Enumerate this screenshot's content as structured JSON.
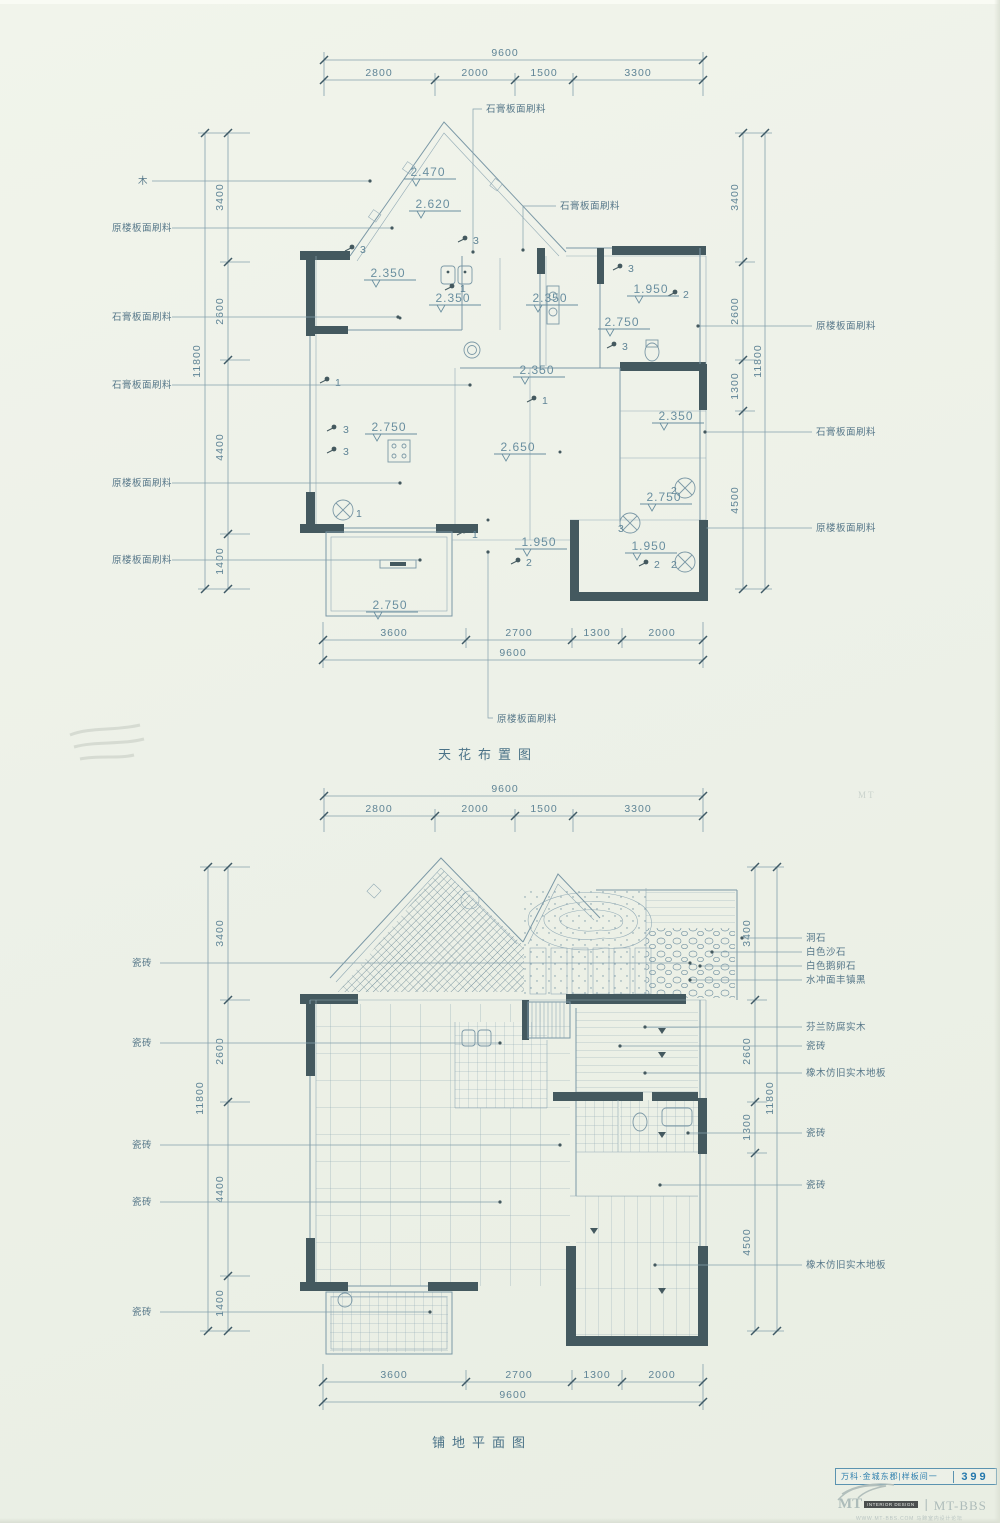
{
  "colors": {
    "paper": "#edf1e8",
    "line": "#7b98a6",
    "dark": "#44595f",
    "text": "#5f8496",
    "blue": "#2e7fae",
    "watermark": "#aebcba"
  },
  "top_plan": {
    "title": "天花布置图",
    "dims": {
      "top_total": "9600",
      "top_segments": [
        "2800",
        "2000",
        "1500",
        "3300"
      ],
      "bottom_total": "9600",
      "bottom_segments": [
        "3600",
        "2700",
        "1300",
        "2000"
      ],
      "left_total": "11800",
      "left_segments": [
        "3400",
        "2600",
        "4400",
        "1400"
      ],
      "right_total": "11800",
      "right_segments": [
        "3400",
        "2600",
        "1300",
        "4500"
      ]
    },
    "labels_left": [
      "木",
      "原楼板面刷料",
      "石膏板面刷料",
      "石膏板面刷料",
      "原楼板面刷料",
      "原楼板面刷料"
    ],
    "labels_right": [
      "原楼板面刷料",
      "石膏板面刷料",
      "原楼板面刷料"
    ],
    "labels_top": [
      "石膏板面刷料",
      "石膏板面刷料"
    ],
    "label_bottom": "原楼板面刷料",
    "levels": [
      "2.470",
      "2.620",
      "2.350",
      "2.350",
      "2.350",
      "1.950",
      "2.750",
      "2.350",
      "2.350",
      "2.750",
      "2.650",
      "2.750",
      "1.950",
      "1.950",
      "2.750"
    ],
    "fixture_tags": [
      "3",
      "3",
      "1",
      "3",
      "3",
      "1",
      "1",
      "1",
      "3",
      "2",
      "3",
      "2",
      "2",
      "1",
      "3",
      "2",
      "2"
    ]
  },
  "bottom_plan": {
    "title": "铺地平面图",
    "dims": {
      "top_total": "9600",
      "top_segments": [
        "2800",
        "2000",
        "1500",
        "3300"
      ],
      "bottom_total": "9600",
      "bottom_segments": [
        "3600",
        "2700",
        "1300",
        "2000"
      ],
      "left_total": "11800",
      "left_segments": [
        "3400",
        "2600",
        "4400",
        "1400"
      ],
      "right_total": "11800",
      "right_segments": [
        "3400",
        "2600",
        "1300",
        "4500"
      ]
    },
    "labels_left": [
      "瓷砖",
      "瓷砖",
      "瓷砖",
      "瓷砖",
      "瓷砖"
    ],
    "labels_right": [
      "洞石",
      "白色沙石",
      "白色鹅卵石",
      "水冲面丰镇黑",
      "芬兰防腐实木",
      "瓷砖",
      "橡木仿旧实木地板",
      "瓷砖",
      "瓷砖",
      "橡木仿旧实木地板"
    ]
  },
  "footer": {
    "label": "万科·金城东郡|样板间一",
    "page": "399"
  },
  "watermark": {
    "mt": "MT",
    "badge": "INTERIOR DESIGN",
    "brand": "丨MT-BBS",
    "url": "WWW.MT-BBS.COM",
    "cn": "马蹄室内设计论坛"
  }
}
